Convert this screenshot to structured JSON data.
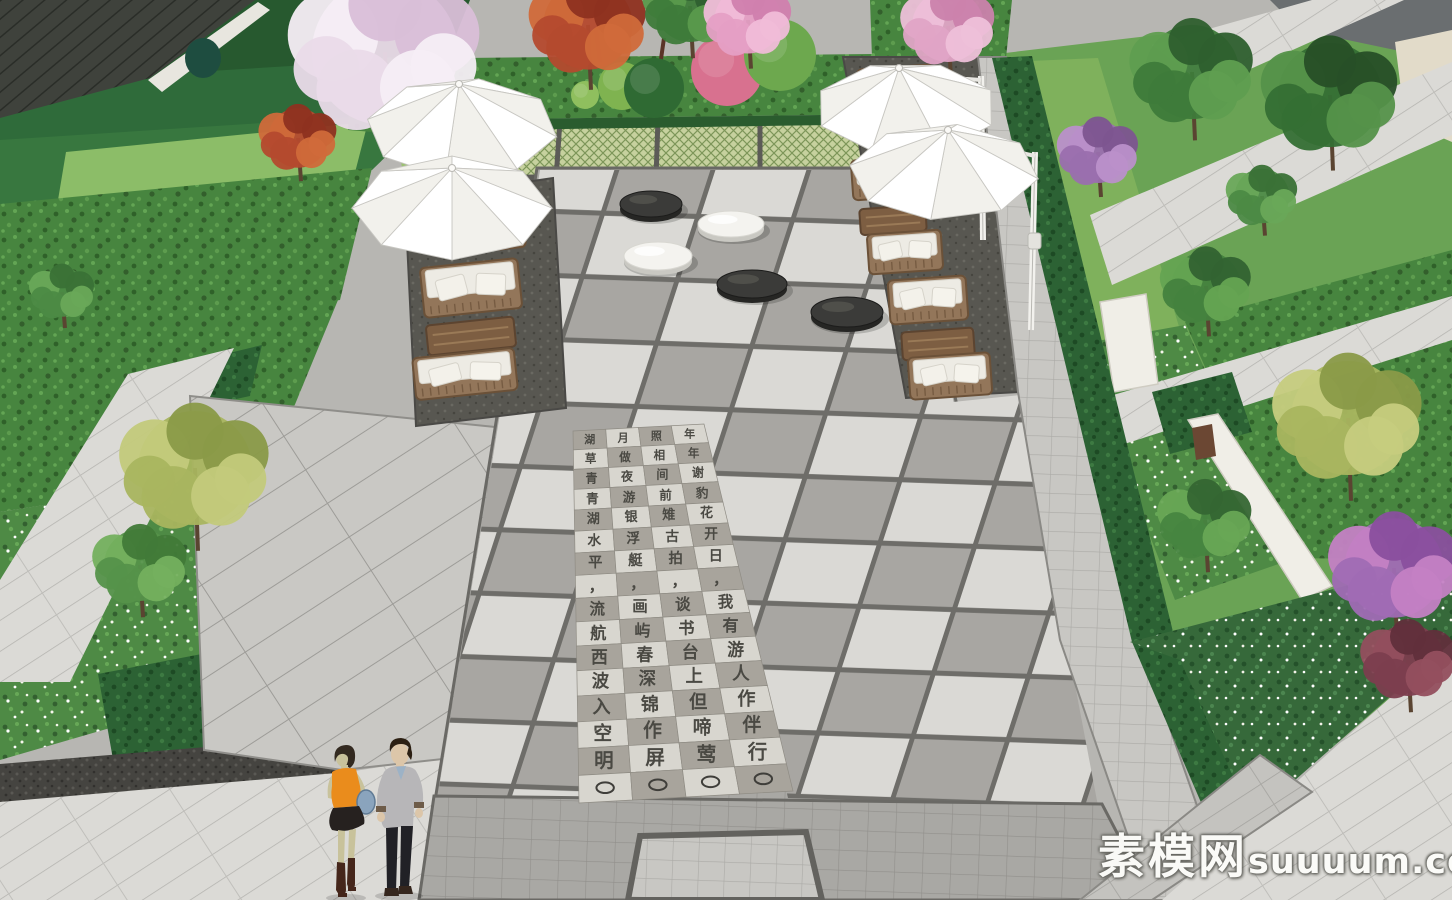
{
  "scene": {
    "description": "3D landscape render of a residential courtyard plaza with parasols, rattan sofas, giant go-stone sculptures and a carved poem paving band",
    "style": "sketchup-render",
    "people_count": 2,
    "umbrella_count": 4,
    "go_stone_count": 5
  },
  "watermark": {
    "site_name_cn": "素模网",
    "site_domain": "suuuum.com"
  },
  "palette": {
    "paving_light": "#dbdad6",
    "paving_mid": "#a8a6a2",
    "paving_dark_joint": "#6e6d69",
    "terrace_dark": "#565550",
    "lawn": "#8cbd68",
    "groundcover": "#47853f",
    "hedge": "#2c6234",
    "umbrella_white": "#ffffff",
    "stone_black": "#3b3b39",
    "stone_white": "#f4f3ef",
    "wall_white": "#f0eee7",
    "wood": "#8a6d50"
  },
  "plaza": {
    "poem_band": {
      "corners": {
        "tl": [
          573,
          431
        ],
        "tr": [
          704,
          424
        ],
        "bl": [
          579,
          803
        ],
        "br": [
          793,
          791
        ]
      },
      "rows": 16,
      "cols": 4,
      "tile_light": "#d8d6cf",
      "tile_dark": "#a8a49c",
      "char_color": "#4a4943",
      "tiles": [
        [
          "湖",
          "月",
          "照",
          "年"
        ],
        [
          "草",
          "做",
          "相",
          "年"
        ],
        [
          "青",
          "夜",
          "间",
          "谢"
        ],
        [
          "青",
          "游",
          "前",
          "豹"
        ],
        [
          "湖",
          "银",
          "雉",
          "花"
        ],
        [
          "水",
          "浮",
          "古",
          "开"
        ],
        [
          "平",
          "艇",
          "拍",
          "日"
        ],
        [
          "，",
          "，",
          "，",
          "，"
        ],
        [
          "流",
          "画",
          "谈",
          "我"
        ],
        [
          "航",
          "屿",
          "书",
          "有"
        ],
        [
          "西",
          "春",
          "台",
          "游"
        ],
        [
          "波",
          "深",
          "上",
          "人"
        ],
        [
          "入",
          "锦",
          "但",
          "作"
        ],
        [
          "空",
          "作",
          "啼",
          "伴"
        ],
        [
          "明",
          "屏",
          "莺",
          "行"
        ],
        [
          "○",
          "○",
          "○",
          "○"
        ]
      ]
    },
    "go_stones": [
      {
        "color": "black",
        "cx": 651,
        "cy": 204,
        "rx": 31,
        "ry": 13
      },
      {
        "color": "white",
        "cx": 731,
        "cy": 224,
        "rx": 33,
        "ry": 13
      },
      {
        "color": "white",
        "cx": 658,
        "cy": 256,
        "rx": 34,
        "ry": 14
      },
      {
        "color": "black",
        "cx": 752,
        "cy": 284,
        "rx": 35,
        "ry": 14
      },
      {
        "color": "black",
        "cx": 847,
        "cy": 312,
        "rx": 36,
        "ry": 15
      }
    ],
    "umbrellas": [
      {
        "id": "left-upper",
        "apex": [
          459,
          84
        ],
        "cx": 462,
        "cy": 128,
        "rx": 96,
        "ry": 50,
        "phase": 10,
        "pole": null
      },
      {
        "id": "left-lower",
        "apex": [
          452,
          168
        ],
        "cx": 452,
        "cy": 208,
        "rx": 100,
        "ry": 52,
        "phase": 0,
        "pole": null
      },
      {
        "id": "right-upper",
        "apex": [
          899,
          68
        ],
        "cx": 906,
        "cy": 108,
        "rx": 92,
        "ry": 46,
        "phase": 22,
        "pole": [
          981,
          76,
          983,
          240
        ]
      },
      {
        "id": "right-lower",
        "apex": [
          948,
          130
        ],
        "cx": 944,
        "cy": 172,
        "rx": 95,
        "ry": 48,
        "phase": 8,
        "pole": [
          1035,
          152,
          1031,
          330
        ]
      }
    ],
    "furniture": [
      {
        "type": "sofa",
        "x": 896,
        "y": 88,
        "w": 76,
        "h": 42,
        "rot": -4
      },
      {
        "type": "sofa",
        "x": 888,
        "y": 178,
        "w": 72,
        "h": 40,
        "rot": -4
      },
      {
        "type": "table",
        "x": 893,
        "y": 220,
        "w": 66,
        "h": 26,
        "rot": -4
      },
      {
        "type": "sofa",
        "x": 905,
        "y": 252,
        "w": 74,
        "h": 40,
        "rot": -4
      },
      {
        "type": "sofa",
        "x": 928,
        "y": 300,
        "w": 78,
        "h": 44,
        "rot": -4
      },
      {
        "type": "table",
        "x": 938,
        "y": 344,
        "w": 72,
        "h": 28,
        "rot": -4
      },
      {
        "type": "sofa",
        "x": 950,
        "y": 376,
        "w": 82,
        "h": 42,
        "rot": -4
      },
      {
        "type": "lounge",
        "x": 484,
        "y": 238,
        "w": 82,
        "h": 26,
        "rot": -6
      },
      {
        "type": "sofa",
        "x": 471,
        "y": 288,
        "w": 98,
        "h": 50,
        "rot": -6
      },
      {
        "type": "table",
        "x": 471,
        "y": 336,
        "w": 88,
        "h": 30,
        "rot": -6
      },
      {
        "type": "sofa",
        "x": 465,
        "y": 374,
        "w": 102,
        "h": 42,
        "rot": -6
      }
    ],
    "people": [
      {
        "id": "woman",
        "pos": [
          322,
          742
        ],
        "skin": "#c8c29b",
        "hair": "#332a20",
        "top": "#ea8c1c",
        "skirt": "#26211f",
        "boots": "#45261b",
        "bag": "#8aa4bd"
      },
      {
        "id": "man",
        "pos": [
          368,
          736
        ],
        "skin": "#dcc6a9",
        "hair": "#2c2013",
        "sweater": "#b7b6b8",
        "shirt": "#9cb2c6",
        "pants": "#212126",
        "shoes": "#35261d",
        "cuff": "#6e5c49"
      }
    ],
    "trees": [
      {
        "id": "cherry-blossom-top-left",
        "x": 385,
        "y": 52,
        "r": 118,
        "c": [
          "#eadbe9",
          "#f6eef5",
          "#d9bfd8"
        ]
      },
      {
        "id": "red-maple-top",
        "x": 588,
        "y": 25,
        "r": 72,
        "c": [
          "#b44a2e",
          "#d06a3a",
          "#8e3220"
        ]
      },
      {
        "id": "red-maple-left",
        "x": 298,
        "y": 138,
        "r": 48,
        "c": [
          "#b44a2e",
          "#d06a3a",
          "#8e3220"
        ]
      },
      {
        "id": "green-tree-top",
        "x": 690,
        "y": 6,
        "r": 58,
        "c": [
          "#3e7b3a",
          "#5a9a4c",
          "#2f6030"
        ]
      },
      {
        "id": "pink-tree-top",
        "x": 748,
        "y": 20,
        "r": 54,
        "c": [
          "#e59fc5",
          "#f0bcd8",
          "#d07fae"
        ]
      },
      {
        "id": "pink-tree-top-right",
        "x": 948,
        "y": 26,
        "r": 58,
        "c": [
          "#e0a4c6",
          "#eec0d9",
          "#cb82ac"
        ]
      },
      {
        "id": "yellow-tree-left",
        "x": 195,
        "y": 468,
        "r": 92,
        "c": [
          "#a9b55f",
          "#c3ca7b",
          "#8a9a48"
        ]
      },
      {
        "id": "green-tree-left",
        "x": 140,
        "y": 565,
        "r": 58,
        "c": [
          "#55924a",
          "#74b05e",
          "#417a38"
        ]
      },
      {
        "id": "green-tree-left-upper",
        "x": 62,
        "y": 292,
        "r": 40,
        "c": [
          "#4c8a44",
          "#69a858",
          "#3a7136"
        ]
      },
      {
        "id": "green-tree-right-top",
        "x": 1192,
        "y": 72,
        "r": 76,
        "c": [
          "#3e7b3a",
          "#5f9e50",
          "#2e5f2e"
        ]
      },
      {
        "id": "green-tree-right-top-2",
        "x": 1330,
        "y": 95,
        "r": 84,
        "c": [
          "#356f34",
          "#55924a",
          "#274f27"
        ]
      },
      {
        "id": "purple-tree-right-top",
        "x": 1098,
        "y": 152,
        "r": 50,
        "c": [
          "#9a6fae",
          "#ba90ca",
          "#7d5590"
        ]
      },
      {
        "id": "green-tree-right-mid",
        "x": 1206,
        "y": 286,
        "r": 56,
        "c": [
          "#44823e",
          "#65a452",
          "#336331"
        ]
      },
      {
        "id": "green-tree-right-small",
        "x": 1262,
        "y": 196,
        "r": 44,
        "c": [
          "#4c8a44",
          "#69a858",
          "#3a7136"
        ]
      },
      {
        "id": "yellow-tree-right",
        "x": 1348,
        "y": 418,
        "r": 92,
        "c": [
          "#a9b55f",
          "#c6cc7e",
          "#8a9a48"
        ]
      },
      {
        "id": "purple-flower-tree-right",
        "x": 1394,
        "y": 568,
        "r": 80,
        "c": [
          "#a06cb4",
          "#c481c4",
          "#8a4f9e"
        ]
      },
      {
        "id": "dark-red-tree-right",
        "x": 1408,
        "y": 660,
        "r": 58,
        "c": [
          "#7c3e4e",
          "#944f5e",
          "#612f3b"
        ]
      },
      {
        "id": "green-shrub-bottom-right",
        "x": 1205,
        "y": 520,
        "r": 58,
        "c": [
          "#478540",
          "#68a655",
          "#356633"
        ]
      }
    ],
    "bed_shrubs": [
      {
        "id": "shrub-ball-light",
        "x": 622,
        "y": 86,
        "r": 24,
        "c": "#7fb350"
      },
      {
        "id": "shrub-mound-dark",
        "x": 654,
        "y": 88,
        "r": 30,
        "c": "#2f6a33"
      },
      {
        "id": "shrub-pink",
        "x": 727,
        "y": 70,
        "r": 36,
        "c": "#d8718f"
      },
      {
        "id": "shrub-ball-green",
        "x": 780,
        "y": 55,
        "r": 36,
        "c": "#6da84e"
      },
      {
        "id": "shrub-small",
        "x": 585,
        "y": 95,
        "r": 14,
        "c": "#8fbf5e"
      }
    ]
  }
}
